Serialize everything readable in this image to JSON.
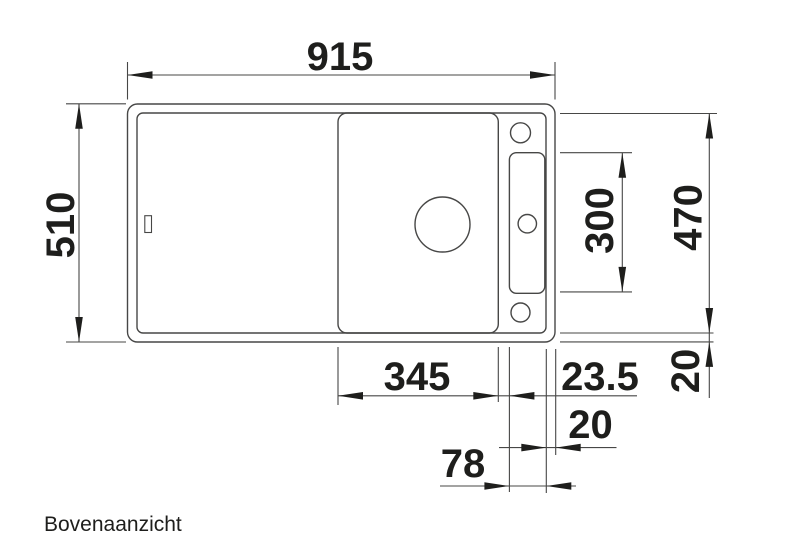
{
  "page": {
    "caption": "Bovenaanzicht",
    "background_color": "#ffffff"
  },
  "style": {
    "line_color": "#474746",
    "ink_color": "#1e1e1c"
  },
  "drawing": {
    "type": "technical-top-view-dimension-drawing",
    "subject": "kitchen sink seen from above with cutting board area, bowl with drain hole, tap ledge with accessory groove and three tap holes",
    "units": "mm"
  },
  "dims": {
    "overall_width": "915",
    "overall_depth": "510",
    "inner_depth": "470",
    "groove_length": "300",
    "bowl_length": "345",
    "bowl_groove_gap": "23.5",
    "rim_side": "20",
    "rim_front": "20",
    "ledge_width": "78"
  }
}
